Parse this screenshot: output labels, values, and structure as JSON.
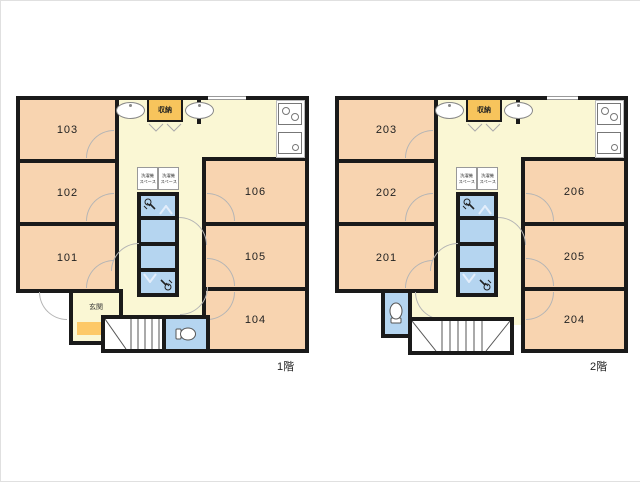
{
  "colors": {
    "wall": "#1a1a1a",
    "room_fill": "#f8d4b0",
    "corridor_fill": "#faf7d4",
    "wet_area_fill": "#b5d5f0",
    "storage_fill": "#f7c45c",
    "entrance_step_fill": "#fdc968",
    "door_arc": "#b5b5b5"
  },
  "icons": {
    "washbasin": "washbasin-icon (oval sink)",
    "storage_doors": "bifold-door-icon (double V)",
    "stove": "stove-icon (two burners)",
    "kitchen_sink": "kitchen-sink-icon",
    "shower": "shower-icon (hand shower head)",
    "toilet": "toilet-icon",
    "stairs": "stairs-icon (treads + diagonal)",
    "door": "door-arc-icon (quarter circle swing)",
    "window": "window-icon (gap in wall)"
  },
  "floors": [
    {
      "floor_label": "1階",
      "left_rooms": [
        "103",
        "102",
        "101"
      ],
      "right_rooms": [
        "106",
        "105",
        "104"
      ],
      "storage_label": "収納",
      "entrance_label": "玄関",
      "laundry_boxes": [
        {
          "line1": "洗濯機",
          "line2": "スペース"
        },
        {
          "line1": "洗濯機",
          "line2": "スペース"
        }
      ]
    },
    {
      "floor_label": "2階",
      "left_rooms": [
        "203",
        "202",
        "201"
      ],
      "right_rooms": [
        "206",
        "205",
        "204"
      ],
      "storage_label": "収納",
      "laundry_boxes": [
        {
          "line1": "洗濯機",
          "line2": "スペース"
        },
        {
          "line1": "洗濯機",
          "line2": "スペース"
        }
      ]
    }
  ]
}
